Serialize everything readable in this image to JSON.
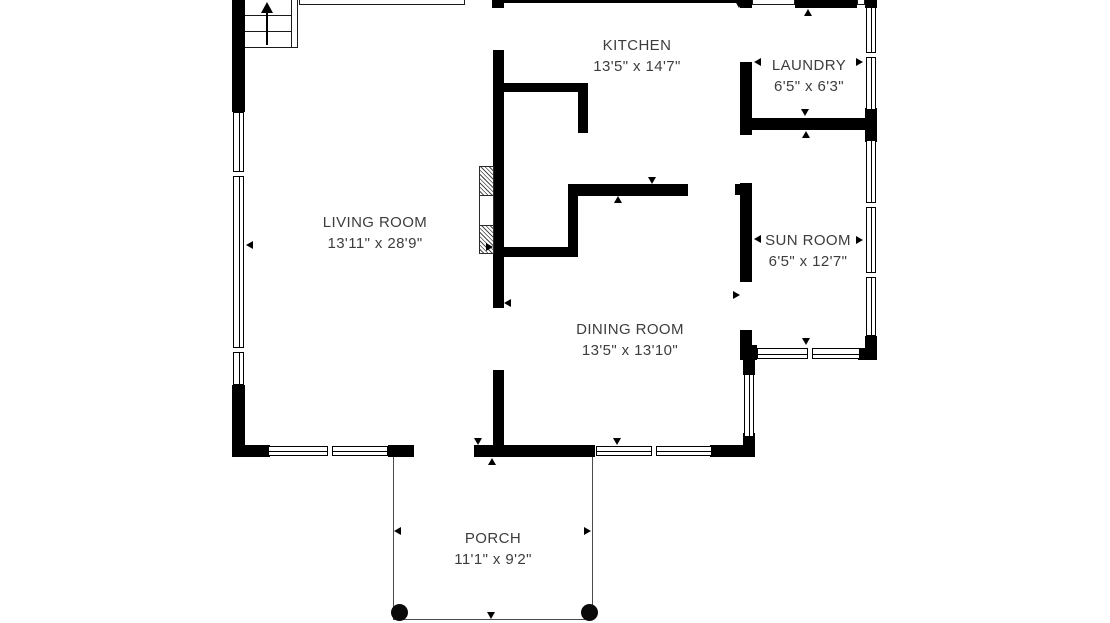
{
  "rooms": {
    "living_room": {
      "name": "LIVING ROOM",
      "dims": "13'11\" x 28'9\""
    },
    "kitchen": {
      "name": "KITCHEN",
      "dims": "13'5\" x 14'7\""
    },
    "laundry": {
      "name": "LAUNDRY",
      "dims": "6'5\" x 6'3\""
    },
    "sun_room": {
      "name": "SUN ROOM",
      "dims": "6'5\" x 12'7\""
    },
    "dining_room": {
      "name": "DINING ROOM",
      "dims": "13'5\" x 13'10\""
    },
    "porch": {
      "name": "PORCH",
      "dims": "11'1\" x 9'2\""
    }
  },
  "colors": {
    "wall": "#000000",
    "label_text": "#3d3d3d",
    "porch_outline": "#4a4a4a",
    "background": "#ffffff"
  }
}
